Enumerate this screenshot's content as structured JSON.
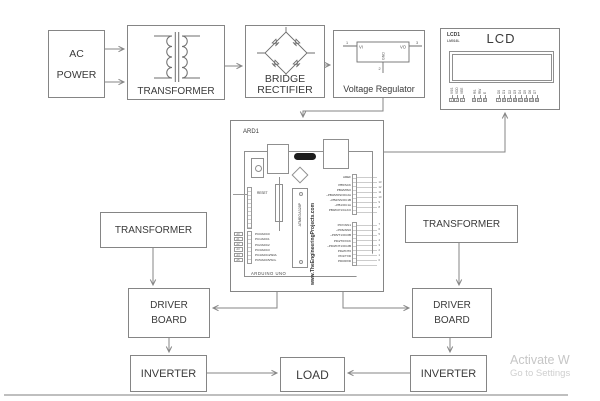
{
  "diagram": {
    "blocks": {
      "ac_power": {
        "lines": [
          "AC",
          "POWER"
        ]
      },
      "transformer_top": {
        "label": "TRANSFORMER"
      },
      "bridge_rectifier": {
        "lines": [
          "BRIDGE",
          "RECTIFIER"
        ]
      },
      "voltage_regulator": {
        "label": "Voltage Regulator",
        "symbol": {
          "vi": "VI",
          "vo": "VO",
          "gnd": "GND",
          "pin_in": "1",
          "pin_gnd": "2",
          "pin_out": "3"
        }
      },
      "lcd": {
        "ref": "LCD1",
        "part": "LM016L",
        "title": "LCD",
        "pin_labels": [
          "VSS",
          "VDD",
          "VEE",
          "RS",
          "RW",
          "E",
          "D0",
          "D1",
          "D2",
          "D3",
          "D4",
          "D5",
          "D6",
          "D7"
        ],
        "pin_numbers": [
          "1",
          "2",
          "3",
          "4",
          "5",
          "6",
          "7",
          "8",
          "9",
          "10",
          "11",
          "12",
          "13",
          "14"
        ]
      },
      "arduino": {
        "ref": "ARD1",
        "board_name": "ARDUINO UNO",
        "website": "www.TheEngineeringProjects.com",
        "mcu": "ATMEGA328P",
        "reset_label": "RESET",
        "aref_label": "AREF",
        "digital_pins_upper": [
          "PB5/SCK",
          "PB4/MISO",
          "~PB3/MOSI/OC2A",
          "~PB2/SS/OC1B",
          "~PB1/OC1A",
          "PB0/ICP1/CLKO"
        ],
        "digital_pins_lower": [
          "PD7/AIN1",
          "~PD6/AIN0",
          "~PD5/T1/OC0B",
          "PD4/T0/XCK",
          "~PD3/INT1/OC2B",
          "PD2/INT0",
          "PD1/TXD",
          "PD0/RXD"
        ],
        "analog_pins": [
          "PC0/ADC0",
          "PC1/ADC1",
          "PC2/ADC2",
          "PC3/ADC3",
          "PC4/ADC4/SDA",
          "PC5/ADC5/SCL"
        ],
        "analog_headers": [
          "A0",
          "A1",
          "A2",
          "A3",
          "A4",
          "A5"
        ],
        "digital_headers_upper": [
          "13",
          "12",
          "11",
          "10",
          "9",
          "8"
        ],
        "digital_headers_lower": [
          "7",
          "6",
          "5",
          "4",
          "3",
          "2",
          "1",
          "0"
        ]
      },
      "transformer_left": {
        "label": "TRANSFORMER"
      },
      "transformer_right": {
        "label": "TRANSFORMER"
      },
      "driver_board_left": {
        "lines": [
          "DRIVER",
          "BOARD"
        ]
      },
      "driver_board_right": {
        "lines": [
          "DRIVER",
          "BOARD"
        ]
      },
      "inverter_left": {
        "label": "INVERTER"
      },
      "inverter_right": {
        "label": "INVERTER"
      },
      "load": {
        "label": "LOAD"
      }
    },
    "watermark": {
      "line1": "Activate W",
      "line2": "Go to Settings"
    },
    "colors": {
      "wire": "#858585",
      "box_border": "#858585",
      "text": "#3b3b3b",
      "watermark": "#c6c6c6"
    }
  }
}
